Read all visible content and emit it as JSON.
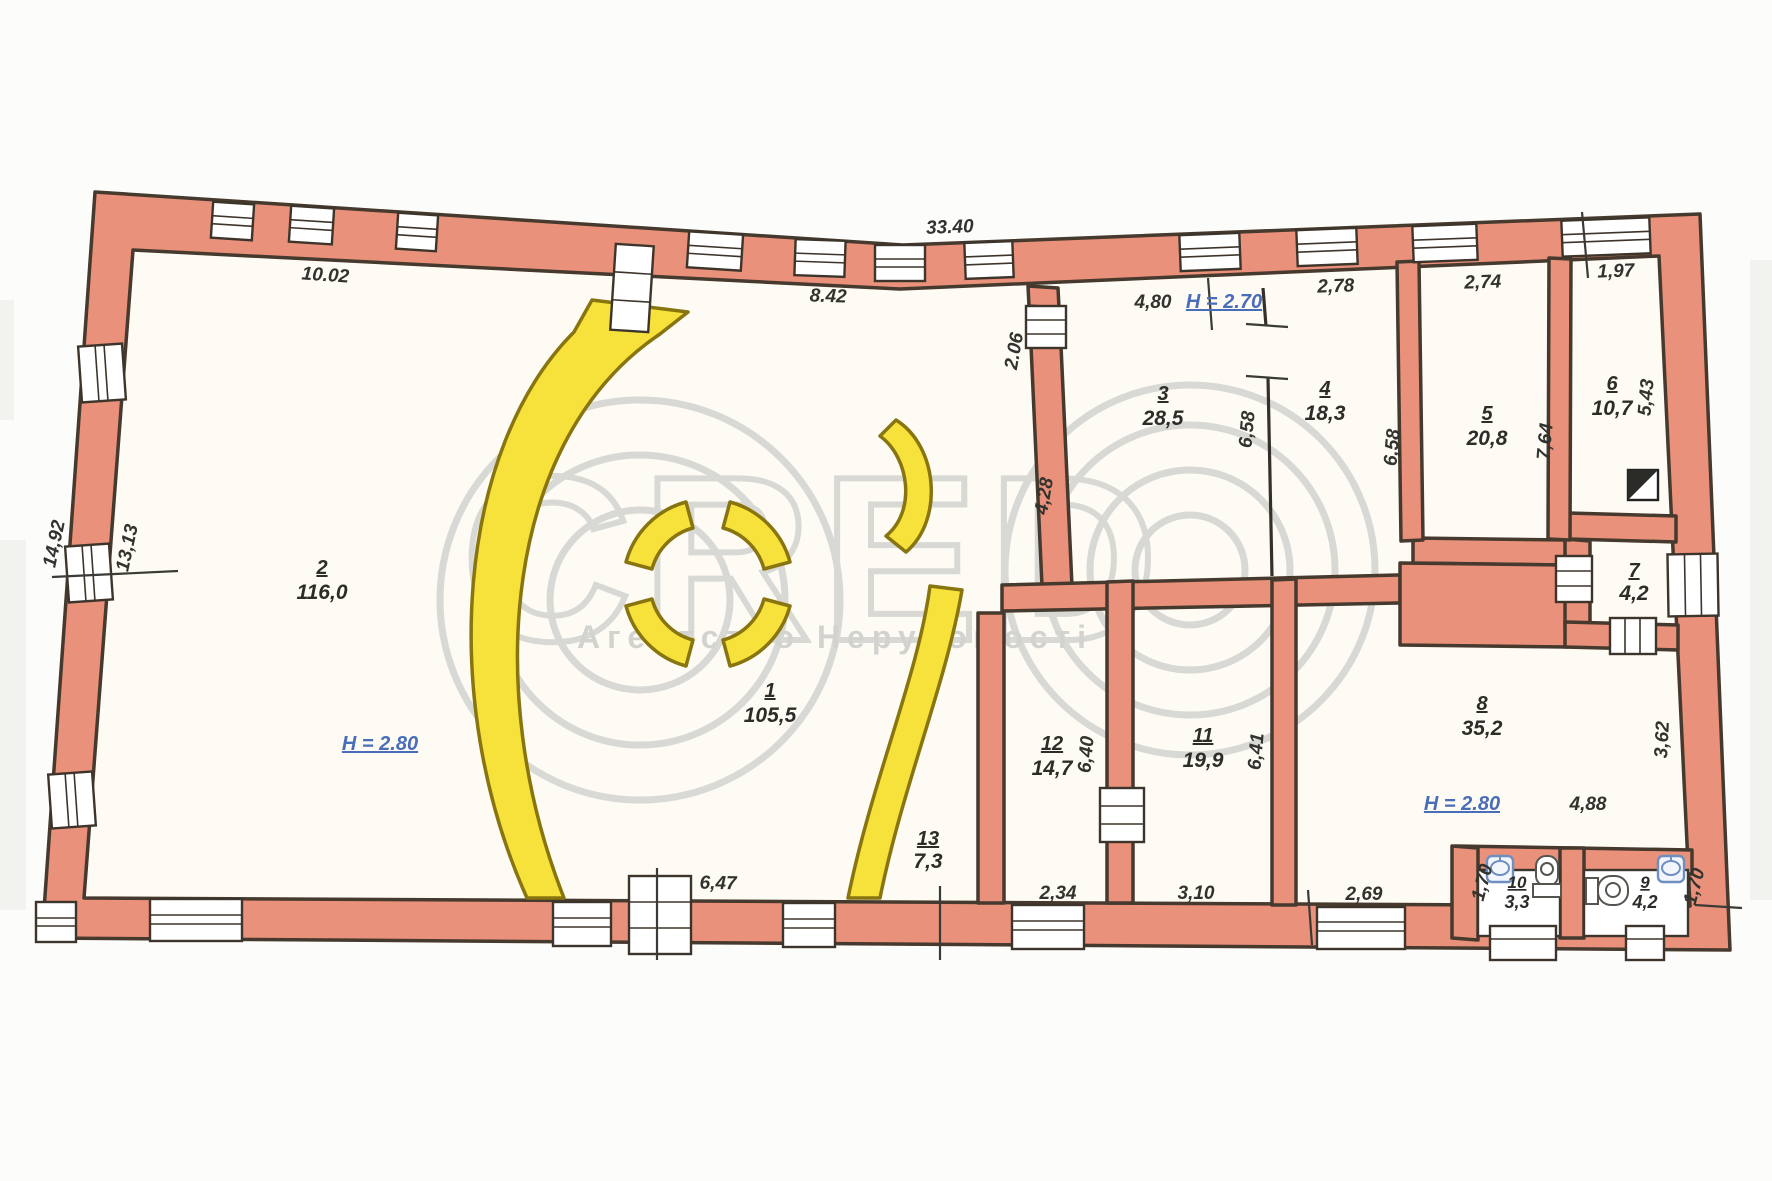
{
  "watermark": {
    "brand_letters": "CRED",
    "subtitle": "Агентство Нерухомості"
  },
  "rooms": {
    "r1": {
      "number": "1",
      "area": "105,5"
    },
    "r2": {
      "number": "2",
      "area": "116,0"
    },
    "r3": {
      "number": "3",
      "area": "28,5"
    },
    "r4": {
      "number": "4",
      "area": "18,3"
    },
    "r5": {
      "number": "5",
      "area": "20,8"
    },
    "r6": {
      "number": "6",
      "area": "10,7"
    },
    "r7": {
      "number": "7",
      "area": "4,2"
    },
    "r8": {
      "number": "8",
      "area": "35,2"
    },
    "r9": {
      "number": "9",
      "area": "4,2"
    },
    "r10": {
      "number": "10",
      "area": "3,3"
    },
    "r11": {
      "number": "11",
      "area": "19,9"
    },
    "r12": {
      "number": "12",
      "area": "14,7"
    },
    "r13": {
      "number": "13",
      "area": "7,3"
    }
  },
  "heights": {
    "room2": "H = 2.80",
    "room3": "H = 2.70",
    "room8": "H = 2.80"
  },
  "dims": {
    "top_total": "33.40",
    "top_left": "10.02",
    "top_center": "8.42",
    "room3_top": "4,80",
    "room4_top": "2,78",
    "room5_top": "2,74",
    "room6_top": "1,97",
    "wall_206": "2.06",
    "wall_428": "4,28",
    "room3_side": "6,58",
    "room4_side": "6,58",
    "room5_side": "7,64",
    "room6_side": "5,43",
    "left_outer": "14,92",
    "left_inner": "13,13",
    "room12_side": "6,40",
    "room11_side": "6,41",
    "room8_side": "3,62",
    "room8_bottom": "4,88",
    "bottom_room1": "6,47",
    "room12_bottom": "2,34",
    "room11_bottom": "3,10",
    "corridor_bottom": "2,69",
    "bath10_side": "1,70",
    "bath9_side": "1,70"
  },
  "colors": {
    "wall": "#e9917a",
    "wall_outline": "#46392e",
    "curved_wall": "#f7e13b",
    "dimension_text": "#32322e",
    "height_text": "#4a6db8",
    "watermark": "#d2d2d0"
  }
}
